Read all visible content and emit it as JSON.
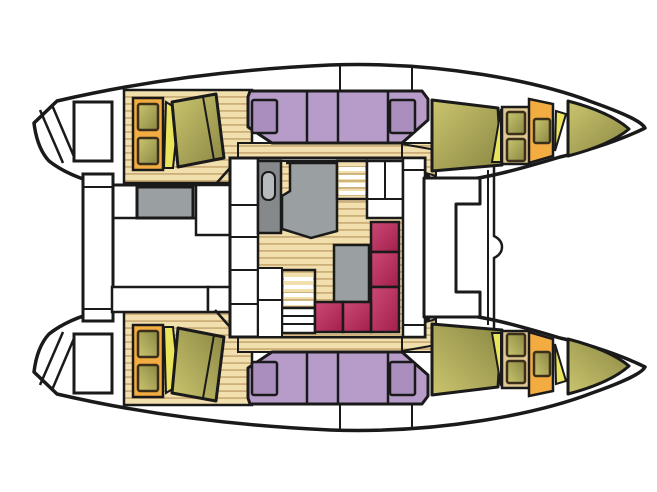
{
  "diagram": {
    "kind": "catamaran-deck-plan",
    "description": "Top-down layout drawing of a sailing catamaran: two hulls with double berths and bow cabins, central salon with galley, chart table, dinette sofa and companionway steps, aft cockpit with table and benches, forward cockpit seat between the bows.",
    "background": "#ffffff",
    "outline": "#1a1a1a"
  },
  "colors": {
    "white": "#ffffff",
    "outline": "#1a1a1a",
    "wood": "#f1e0ad",
    "wood_stripe": "#cdaf79",
    "berth_purple": "#b79cc9",
    "pillow_purple": "#aa8fbe",
    "cushion_light": "#cbc56e",
    "cushion_dark": "#8a8743",
    "accent_yellow": "#eae45c",
    "frame_orange": "#f2ac41",
    "frame_tan": "#dfc793",
    "hatch_stroke": "#3a2f1b",
    "furniture_gray": "#9aa0a2",
    "counter_gray_dark": "#85898c",
    "sink_gray": "#b7bbbd",
    "sofa_red_light": "#cc4876",
    "sofa_red_dark": "#a31f4b"
  }
}
